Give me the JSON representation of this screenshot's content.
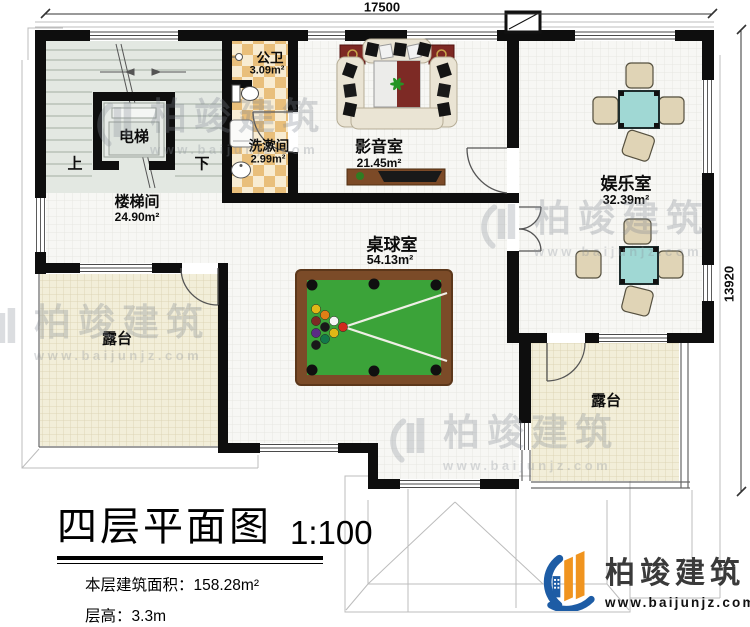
{
  "dimensions": {
    "top": "17500",
    "right": "13920"
  },
  "rooms": [
    {
      "id": "stairwell",
      "name": "楼梯间",
      "area": "24.90m²"
    },
    {
      "id": "elevator",
      "name": "电梯"
    },
    {
      "id": "public-bath",
      "name": "公卫",
      "area": "3.09m²"
    },
    {
      "id": "washroom",
      "name": "洗漱间",
      "area": "2.99m²"
    },
    {
      "id": "media-room",
      "name": "影音室",
      "area": "21.45m²"
    },
    {
      "id": "entertainment",
      "name": "娱乐室",
      "area": "32.39m²"
    },
    {
      "id": "billiards",
      "name": "桌球室",
      "area": "54.13m²"
    },
    {
      "id": "terrace-left",
      "name": "露台"
    },
    {
      "id": "terrace-right",
      "name": "露台"
    }
  ],
  "stairs": {
    "up": "上",
    "down": "下"
  },
  "title_block": {
    "title": "四层平面图",
    "scale": "1:100",
    "area_label": "本层建筑面积：",
    "area_value": "158.28m²",
    "floor_height_label": "层高：",
    "floor_height_value": "3.3m"
  },
  "branding": {
    "company": "柏竣建筑",
    "website": "www.baijunjz.com"
  },
  "colors": {
    "wall": "#0e0e0e",
    "terrace_floor": "#f2eed9",
    "checker_tan": "#e9bf7b",
    "stair_floor": "#e3e8e2",
    "pool_felt": "#3ba339",
    "pool_frame": "#7b4b28",
    "mahjong_table": "#a0d8d4",
    "sofa": "#eae4d4",
    "logo_blue": "#1d5ca5",
    "logo_orange": "#f0941f"
  }
}
